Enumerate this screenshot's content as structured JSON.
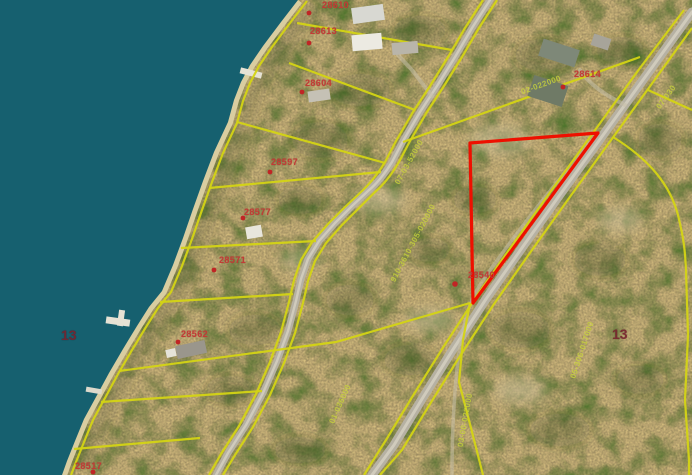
{
  "map": {
    "description": "County GIS aerial parcel map with highlighted parcel",
    "colors": {
      "water": "#16606f",
      "beach": "#d9cda0",
      "road": "#b6b1a3",
      "road_center": "#d0cbbc",
      "trail": "#c7bfa8",
      "parcel_line": "#d4d414",
      "highlight": "#ee1000",
      "label_red": "#c23b36",
      "section": "#77242e",
      "pid": "#c9d53a",
      "dot": "#c02525"
    },
    "section_labels": [
      {
        "text": "13",
        "x": 61,
        "y": 327
      },
      {
        "text": "13",
        "x": 612,
        "y": 326
      }
    ],
    "parcel_labels": [
      {
        "text": "28610",
        "x": 322,
        "y": 0
      },
      {
        "text": "28613",
        "x": 310,
        "y": 26
      },
      {
        "text": "28604",
        "x": 305,
        "y": 78
      },
      {
        "text": "28597",
        "x": 271,
        "y": 157
      },
      {
        "text": "28577",
        "x": 244,
        "y": 207
      },
      {
        "text": "28571",
        "x": 219,
        "y": 255
      },
      {
        "text": "28562",
        "x": 181,
        "y": 329
      },
      {
        "text": "28517",
        "x": 75,
        "y": 461
      },
      {
        "text": "28614",
        "x": 574,
        "y": 69
      },
      {
        "text": "28540",
        "x": 468,
        "y": 270
      }
    ],
    "pid_labels": [
      {
        "text": "910-3610-305-020000",
        "x": 413,
        "y": 243,
        "rot": -62
      },
      {
        "text": "07-03-52000",
        "x": 409,
        "y": 162,
        "rot": -61
      },
      {
        "text": "02-022000",
        "x": 541,
        "y": 85,
        "rot": -20
      },
      {
        "text": "07-030",
        "x": 666,
        "y": 97,
        "rot": -54
      },
      {
        "text": "03-00-022000",
        "x": 465,
        "y": 420,
        "rot": -80
      },
      {
        "text": "05-306-017000",
        "x": 582,
        "y": 350,
        "rot": -72
      },
      {
        "text": "01-036000",
        "x": 340,
        "y": 404,
        "rot": -66
      }
    ],
    "highlighted_parcel": {
      "label": "28540",
      "vertices": "470,143 598,133 473,303"
    }
  }
}
